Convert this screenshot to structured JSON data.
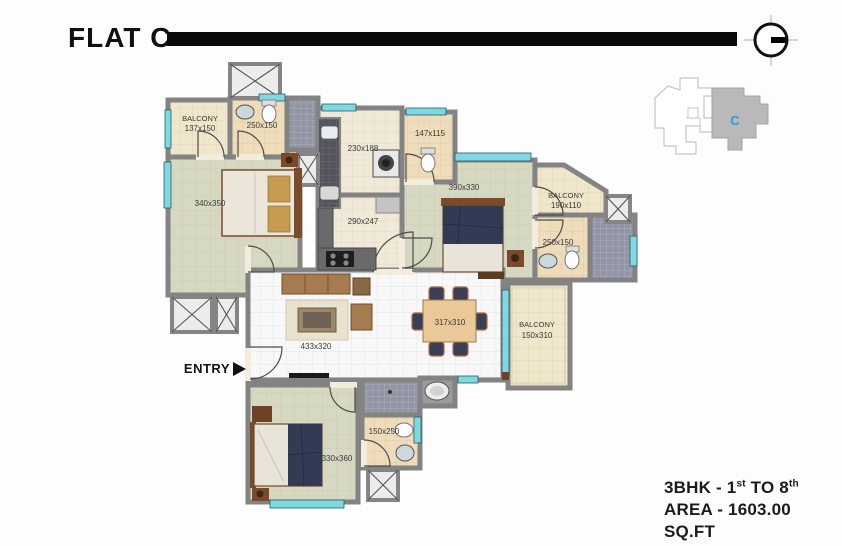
{
  "title": "FLAT C",
  "key_plan": {
    "unit_label": "C"
  },
  "entry_label": "ENTRY",
  "rooms": {
    "balcony_top_left": {
      "name": "BALCONY",
      "dim": "137x150"
    },
    "bath_top": {
      "dim": "250x150"
    },
    "utility": {
      "dim": "230x188"
    },
    "wc": {
      "dim": "147x115"
    },
    "bedroom_top_left": {
      "dim": "340x350"
    },
    "kitchen": {
      "dim": "290x247"
    },
    "bedroom_right": {
      "dim": "390x330"
    },
    "balcony_right_top": {
      "name": "BALCONY",
      "dim": "190x110"
    },
    "bath_right": {
      "dim": "250x150"
    },
    "living": {
      "dim": "433x320"
    },
    "dining": {
      "dim": "317x310"
    },
    "balcony_right_mid": {
      "name": "BALCONY",
      "dim": "150x310"
    },
    "bedroom_bottom": {
      "dim": "330x360"
    },
    "bath_bottom": {
      "dim": "150x250"
    }
  },
  "footer": {
    "line1_prefix": "3BHK - 1",
    "line1_sup1": "st",
    "line1_mid": " TO 8",
    "line1_sup2": "th",
    "line2": "AREA - 1603.00 SQ.FT"
  },
  "colors": {
    "window": "#7fd9e2",
    "wall": "#838383",
    "unit_highlight": "#b9b9b9",
    "unit_label_color": "#2a9fd8"
  }
}
